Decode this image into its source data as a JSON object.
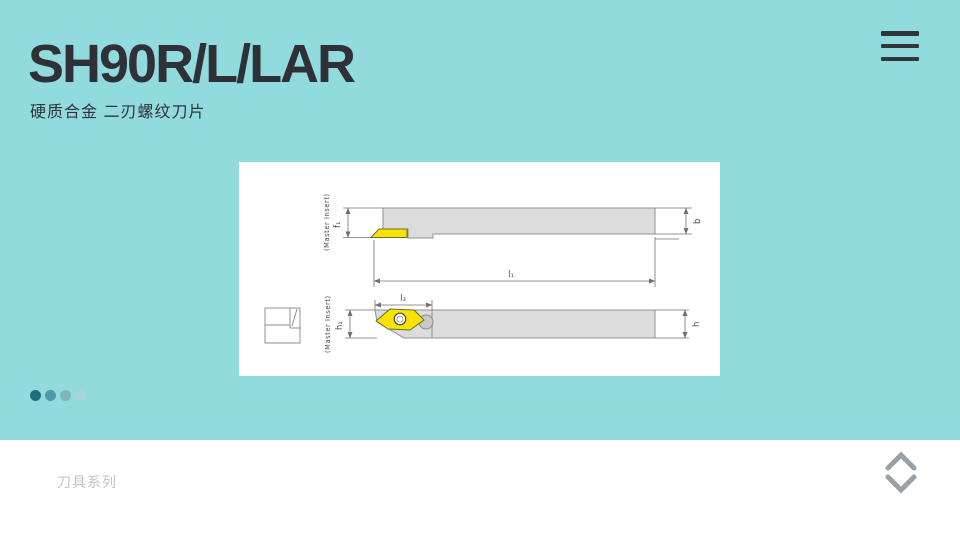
{
  "page": {
    "title": "SH90R/L/LAR",
    "subtitle": "硬质合金 二刃螺纹刀片"
  },
  "header": {
    "menu_icon": "hamburger-menu"
  },
  "diagram": {
    "description": "tool-holder-technical-drawing",
    "top_view": {
      "master_insert": "(Master Insert)",
      "f1": "f₁",
      "b": "b",
      "l1": "l₁"
    },
    "side_view": {
      "master_insert": "(Master Insert)",
      "l3": "l₃",
      "h1": "h₁",
      "h": "h"
    }
  },
  "pagination": {
    "count": 4,
    "active_index": 0,
    "dot_colors": [
      "#1d6e7f",
      "#4f97a6",
      "#7db6c0",
      "#abd3d9"
    ]
  },
  "footer": {
    "series_label": "刀具系列"
  },
  "colors": {
    "bg": "#91dbde",
    "panel": "#ffffff",
    "heading": "#2e3237",
    "subtitle": "#30343a",
    "menu-icon": "#30353a",
    "shank-fill": "#dcdcdc",
    "outline": "#909090",
    "dim-line": "#707070",
    "label-text": "#4a4a4a",
    "insert-yellow": "#f6e400",
    "insert-outline": "#6b6b32",
    "footer-text": "#c0c4c5",
    "chevron": "#9aa0a3"
  }
}
